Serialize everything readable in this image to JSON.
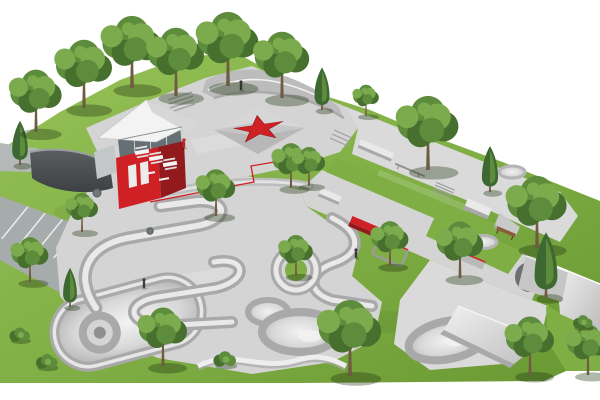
{
  "meta": {
    "description": "3D aerial rendering of a skatepark design on a green lawn: concrete plaza with red star pyramid, skaters building with red container and white winged roof, pump track berms, snake-run bowl, street obstacles with red ledges, parking lot and trees",
    "background": "#ffffff"
  },
  "palette": {
    "white": "#ffffff",
    "grass": "#7fae44",
    "grass-dark": "#699732",
    "grass-light": "#96c257",
    "foliage": "#5d8c3c",
    "foliage-dark": "#47702e",
    "foliage-light": "#7cab4e",
    "conifer": "#3d6831",
    "trunk": "#6f5b42",
    "concrete": "#d4d4d4",
    "concrete2": "#dadada",
    "concrete-light": "#e9e9e9",
    "concrete-dark": "#a9a9a9",
    "concrete-deep": "#8f8f8f",
    "asphalt": "#4c5052",
    "parking": "#a6abab",
    "road": "#b4b8b8",
    "red": "#cf2026",
    "red-dark": "#931a1c",
    "roof": "#f3f3f3",
    "roof-shade": "#d7d7d7",
    "glass": "#667074",
    "bench-wood": "#8a5b39",
    "figure": "#3a3a3a",
    "shadow": "rgba(30,50,15,0.35)"
  },
  "scene": {
    "trees": [
      {
        "type": "conifer",
        "x": 20,
        "y": 165,
        "s": 1.3
      },
      {
        "type": "deciduous",
        "x": 36,
        "y": 132,
        "s": 1.6
      },
      {
        "type": "deciduous",
        "x": 84,
        "y": 108,
        "s": 1.75
      },
      {
        "type": "deciduous",
        "x": 132,
        "y": 88,
        "s": 1.85
      },
      {
        "type": "deciduous",
        "x": 176,
        "y": 96,
        "s": 1.75
      },
      {
        "type": "deciduous",
        "x": 228,
        "y": 86,
        "s": 1.9
      },
      {
        "type": "deciduous",
        "x": 282,
        "y": 98,
        "s": 1.7
      },
      {
        "type": "conifer",
        "x": 322,
        "y": 110,
        "s": 1.25
      },
      {
        "type": "deciduous",
        "x": 366,
        "y": 116,
        "s": 0.8
      },
      {
        "type": "deciduous",
        "x": 428,
        "y": 170,
        "s": 1.9
      },
      {
        "type": "conifer",
        "x": 490,
        "y": 192,
        "s": 1.35
      },
      {
        "type": "deciduous",
        "x": 537,
        "y": 248,
        "s": 1.85
      },
      {
        "type": "deciduous",
        "x": 82,
        "y": 232,
        "s": 1.0
      },
      {
        "type": "deciduous",
        "x": 30,
        "y": 282,
        "s": 1.15
      },
      {
        "type": "conifer",
        "x": 70,
        "y": 307,
        "s": 1.15
      },
      {
        "type": "bush",
        "x": 20,
        "y": 340,
        "s": 1.0
      },
      {
        "type": "bush",
        "x": 47,
        "y": 367,
        "s": 1.05
      },
      {
        "type": "deciduous",
        "x": 216,
        "y": 216,
        "s": 1.2
      },
      {
        "type": "deciduous",
        "x": 291,
        "y": 188,
        "s": 1.15
      },
      {
        "type": "deciduous",
        "x": 309,
        "y": 186,
        "s": 1.0
      },
      {
        "type": "deciduous",
        "x": 296,
        "y": 276,
        "s": 1.05
      },
      {
        "type": "deciduous",
        "x": 390,
        "y": 266,
        "s": 1.15
      },
      {
        "type": "deciduous",
        "x": 460,
        "y": 278,
        "s": 1.45
      },
      {
        "type": "conifer",
        "x": 546,
        "y": 297,
        "s": 1.9
      },
      {
        "type": "deciduous",
        "x": 163,
        "y": 366,
        "s": 1.5
      },
      {
        "type": "bush",
        "x": 225,
        "y": 365,
        "s": 1.1
      },
      {
        "type": "deciduous",
        "x": 350,
        "y": 376,
        "s": 1.95
      },
      {
        "type": "deciduous",
        "x": 530,
        "y": 375,
        "s": 1.5
      },
      {
        "type": "deciduous",
        "x": 588,
        "y": 375,
        "s": 1.3
      },
      {
        "type": "bush",
        "x": 583,
        "y": 327,
        "s": 0.95
      }
    ],
    "figures": [
      {
        "x": 241,
        "y": 90,
        "color": "#3a3a3a"
      },
      {
        "x": 144,
        "y": 288,
        "color": "#3a3a3a"
      },
      {
        "x": 356,
        "y": 258,
        "color": "#3a3a3a"
      },
      {
        "x": 184,
        "y": 148,
        "color": "#c0272d"
      }
    ]
  }
}
